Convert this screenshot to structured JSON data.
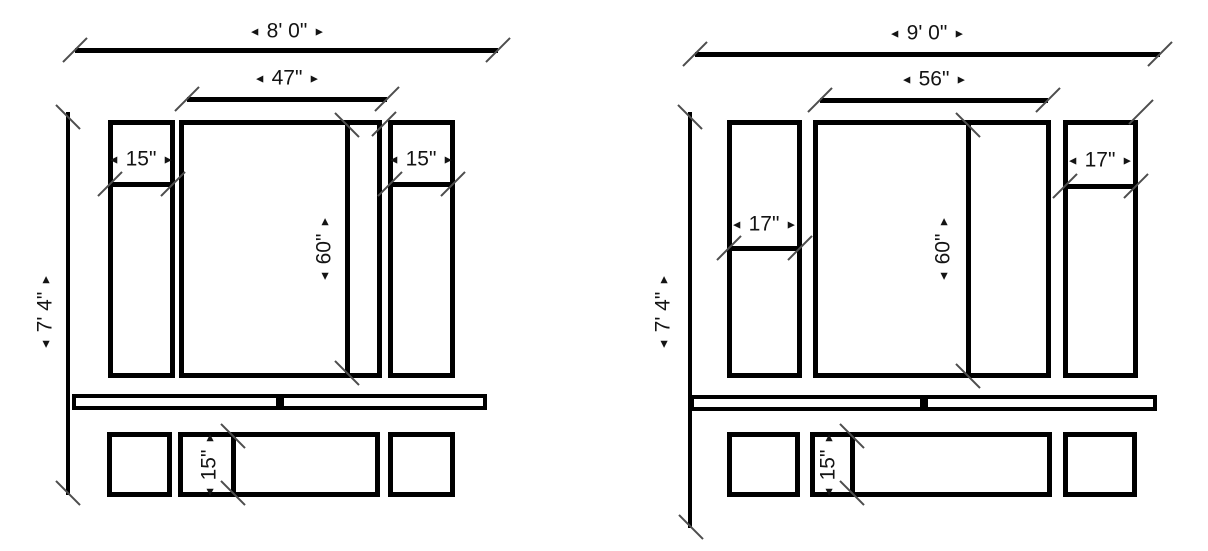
{
  "title": "wainscoting-panel-elevation-drawings",
  "glyphs": {
    "arrow_left": "◄",
    "arrow_right": "►"
  },
  "colors": {
    "line": "#000000",
    "tick": "#4d4d4d",
    "text": "#141414",
    "background": "#ffffff"
  },
  "diagrams": [
    {
      "name": "8-foot-wall-elevation",
      "overall_width": "8' 0\"",
      "center_panel_width": "47\"",
      "overall_height": "7' 4\"",
      "panel_height": "60\"",
      "left_stile_width": "15\"",
      "right_stile_width": "15\"",
      "base_panel_height": "15\""
    },
    {
      "name": "9-foot-wall-elevation",
      "overall_width": "9' 0\"",
      "center_panel_width": "56\"",
      "overall_height": "7' 4\"",
      "panel_height": "60\"",
      "left_stile_width": "17\"",
      "right_stile_width": "17\"",
      "base_panel_height": "15\""
    }
  ]
}
